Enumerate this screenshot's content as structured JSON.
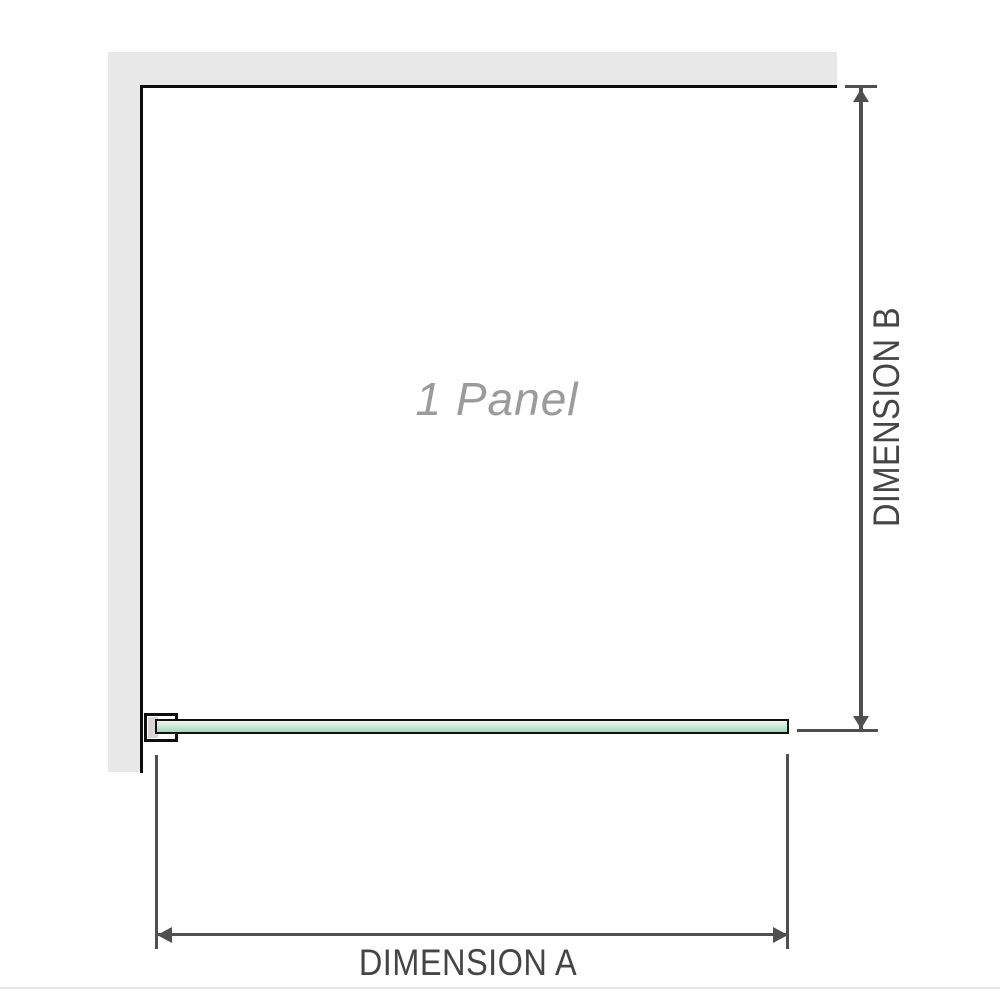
{
  "diagram": {
    "panel_label": "1 Panel",
    "dimension_a": {
      "label": "DIMENSION A"
    },
    "dimension_b": {
      "label": "DIMENSION B"
    }
  },
  "colors": {
    "background": "#ffffff",
    "wall_fill": "#e8e8e8",
    "wall_border": "#0d0d0d",
    "glass_border": "#111111",
    "glass_fill_top": "#eaf7f0",
    "glass_fill_mid": "#cdeadb",
    "glass_fill_bottom": "#a5d6b6",
    "bracket_fill": "#ffffff",
    "bracket_insert": "#d6d6d6",
    "dimension_line": "#4f4f4f",
    "label_color": "#454545",
    "panel_label_color": "#9b9b9b",
    "baseline_rule": "#e7e7e5"
  }
}
